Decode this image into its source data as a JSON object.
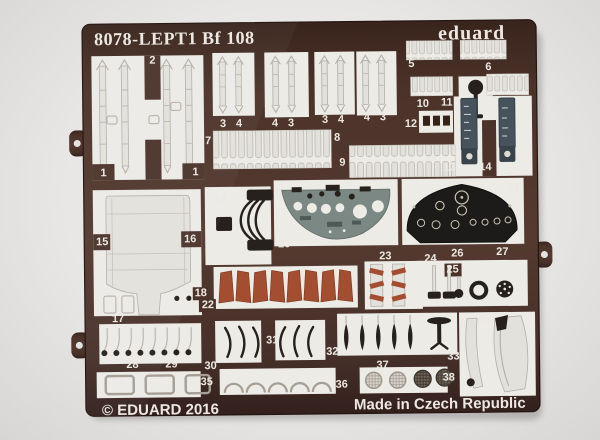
{
  "photo": {
    "header": {
      "title": "8078-LEPT1 Bf 108",
      "brand": "eduard"
    },
    "footer": {
      "copyright": "© EDUARD 2016",
      "origin": "Made in Czech Republic"
    },
    "part_labels": [
      {
        "t": "2",
        "x": 154,
        "y": 62
      },
      {
        "t": "1",
        "x": 104,
        "y": 174
      },
      {
        "t": "1",
        "x": 196,
        "y": 174
      },
      {
        "t": "3",
        "x": 224,
        "y": 126
      },
      {
        "t": "4",
        "x": 240,
        "y": 126
      },
      {
        "t": "4",
        "x": 276,
        "y": 126
      },
      {
        "t": "3",
        "x": 292,
        "y": 126
      },
      {
        "t": "3",
        "x": 326,
        "y": 123
      },
      {
        "t": "4",
        "x": 342,
        "y": 123
      },
      {
        "t": "4",
        "x": 368,
        "y": 121
      },
      {
        "t": "3",
        "x": 384,
        "y": 121
      },
      {
        "t": "5",
        "x": 413,
        "y": 68
      },
      {
        "t": "6",
        "x": 490,
        "y": 72
      },
      {
        "t": "10",
        "x": 424,
        "y": 108
      },
      {
        "t": "11",
        "x": 448,
        "y": 107
      },
      {
        "t": "12",
        "x": 412,
        "y": 128
      },
      {
        "t": "13",
        "x": 450,
        "y": 172
      },
      {
        "t": "14",
        "x": 486,
        "y": 172
      },
      {
        "t": "7",
        "x": 209,
        "y": 143
      },
      {
        "t": "8",
        "x": 338,
        "y": 141
      },
      {
        "t": "9",
        "x": 343,
        "y": 166
      },
      {
        "t": "15",
        "x": 102,
        "y": 243
      },
      {
        "t": "16",
        "x": 190,
        "y": 241
      },
      {
        "t": "18",
        "x": 200,
        "y": 295
      },
      {
        "t": "22",
        "x": 207,
        "y": 307
      },
      {
        "t": "17",
        "x": 117,
        "y": 320
      },
      {
        "t": "19",
        "x": 220,
        "y": 201
      },
      {
        "t": "20",
        "x": 284,
        "y": 247
      },
      {
        "t": "21",
        "x": 514,
        "y": 193
      },
      {
        "t": "23",
        "x": 385,
        "y": 260
      },
      {
        "t": "24",
        "x": 430,
        "y": 263
      },
      {
        "t": "25",
        "x": 452,
        "y": 274
      },
      {
        "t": "26",
        "x": 457,
        "y": 258
      },
      {
        "t": "27",
        "x": 502,
        "y": 257
      },
      {
        "t": "28",
        "x": 131,
        "y": 366
      },
      {
        "t": "29",
        "x": 170,
        "y": 366
      },
      {
        "t": "30",
        "x": 209,
        "y": 368
      },
      {
        "t": "31",
        "x": 271,
        "y": 343
      },
      {
        "t": "32",
        "x": 331,
        "y": 355
      },
      {
        "t": "33",
        "x": 452,
        "y": 361
      },
      {
        "t": "34",
        "x": 483,
        "y": 326
      },
      {
        "t": "35",
        "x": 205,
        "y": 384
      },
      {
        "t": "36",
        "x": 340,
        "y": 388
      },
      {
        "t": "37",
        "x": 381,
        "y": 369
      },
      {
        "t": "38",
        "x": 447,
        "y": 382
      }
    ],
    "colors": {
      "fret": "#4b332a",
      "fret_dark": "#362219",
      "backing": "#edebe6",
      "part_light": "#e3e1dc",
      "part_outline": "#b3afa7",
      "dark_part": "#26211d",
      "panel_grey": "#7b8884",
      "panel_black": "#1d1b19",
      "red_brown": "#a34e31",
      "slate": "#46525c",
      "label": "#ece8e1",
      "photo_bg": "#e5e3e1"
    }
  }
}
